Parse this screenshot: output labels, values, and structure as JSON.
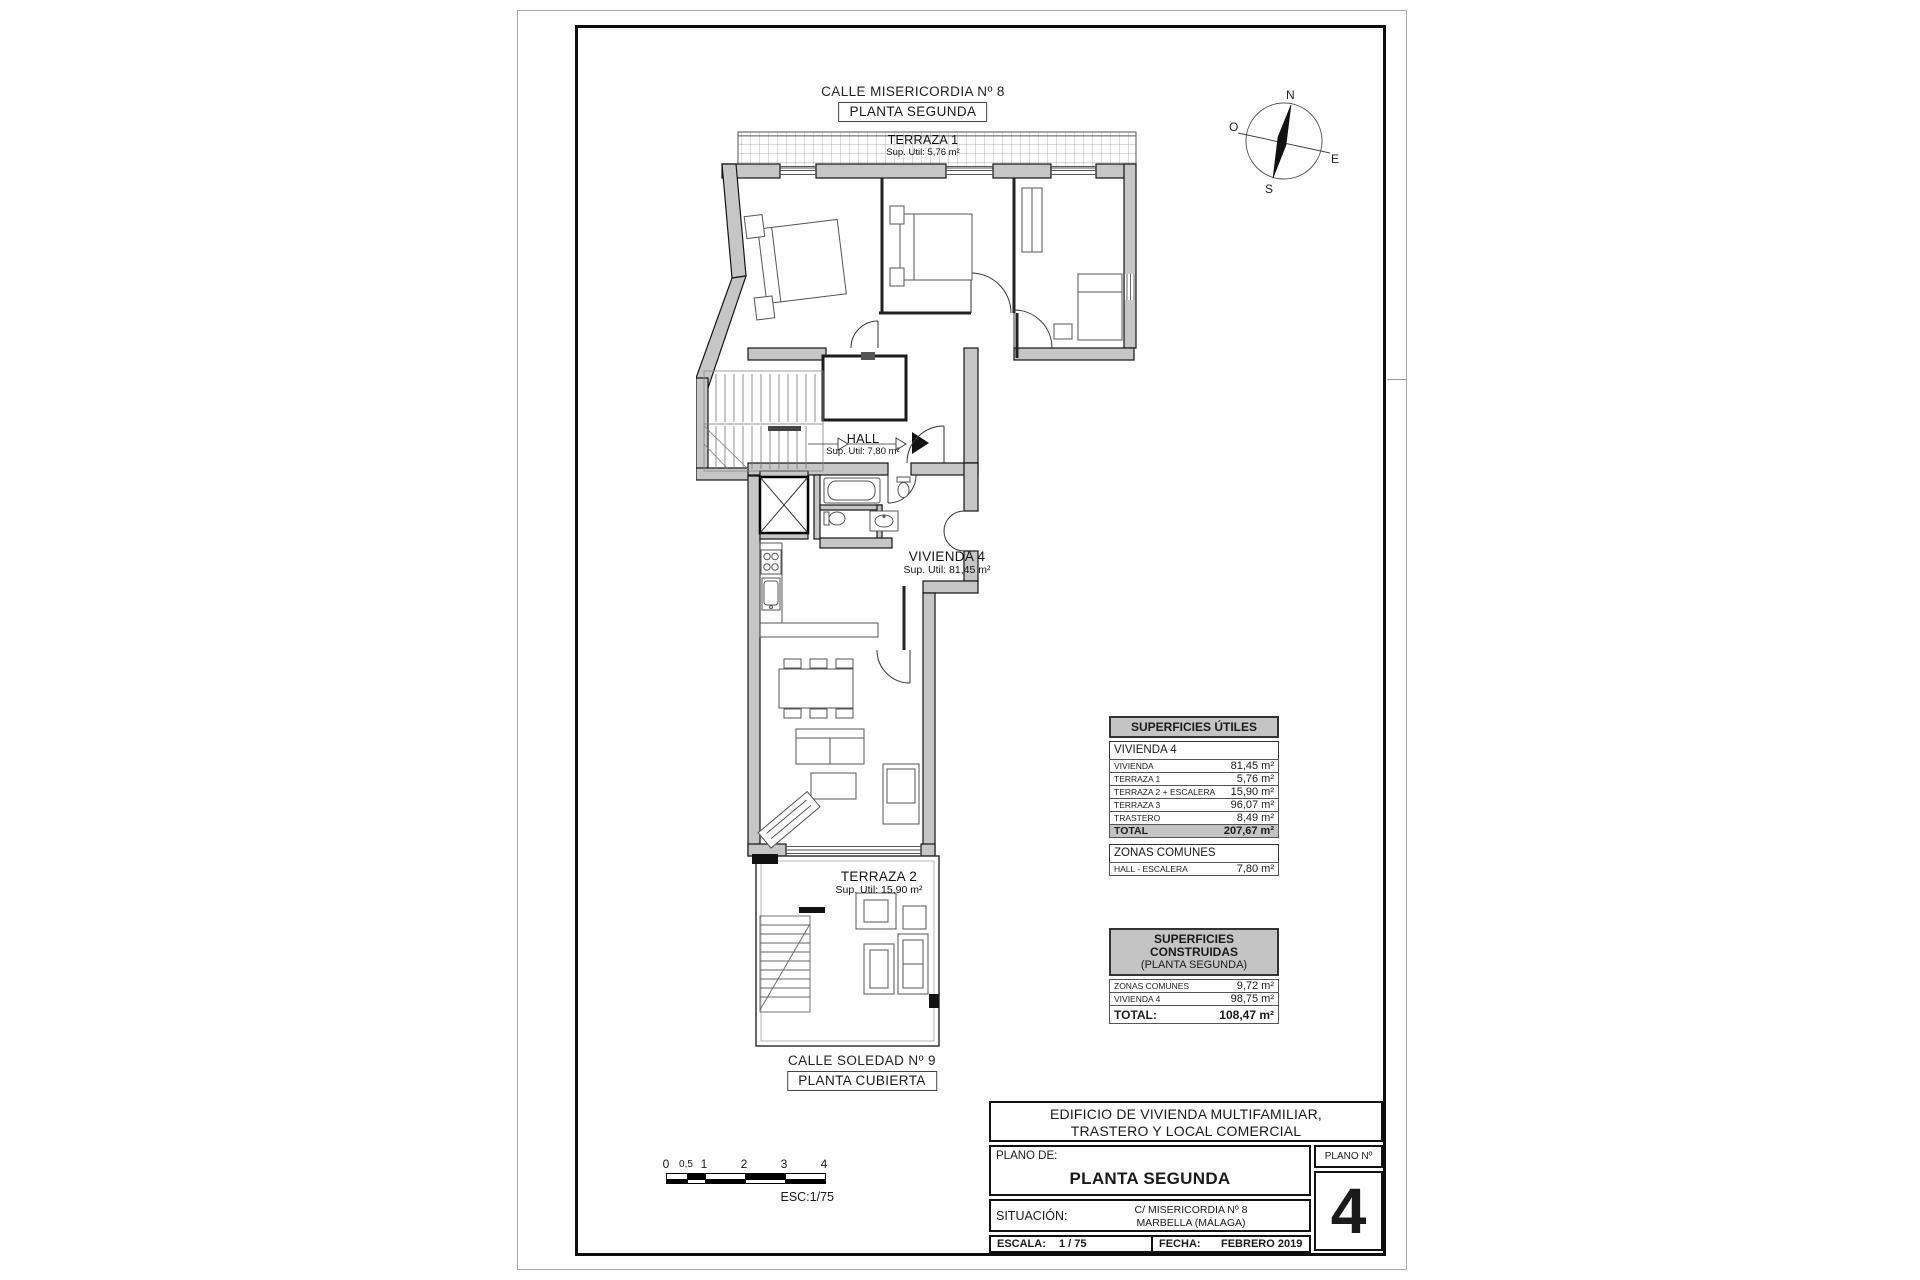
{
  "header": {
    "street": "CALLE MISERICORDIA Nº 8",
    "floor": "PLANTA SEGUNDA"
  },
  "footer": {
    "street": "CALLE SOLEDAD Nº 9",
    "floor": "PLANTA CUBIERTA"
  },
  "compass": {
    "n": "N",
    "s": "S",
    "e": "E",
    "o": "O"
  },
  "rooms": {
    "terraza1": {
      "name": "TERRAZA 1",
      "area": "Sup. Util: 5,76 m²"
    },
    "hall": {
      "name": "HALL",
      "area": "Sup. Util: 7,80 m²"
    },
    "vivienda": {
      "name": "VIVIENDA 4",
      "area": "Sup. Util: 81,45 m²"
    },
    "terraza2": {
      "name": "TERRAZA 2",
      "area": "Sup. Util: 15,90 m²"
    }
  },
  "utiles": {
    "title": "SUPERFICIES ÚTILES",
    "group": "VIVIENDA 4",
    "rows": [
      {
        "label": "VIVIENDA",
        "value": "81,45 m²"
      },
      {
        "label": "TERRAZA 1",
        "value": "5,76 m²"
      },
      {
        "label": "TERRAZA 2 + ESCALERA",
        "value": "15,90 m²"
      },
      {
        "label": "TERRAZA 3",
        "value": "96,07 m²"
      },
      {
        "label": "TRASTERO",
        "value": "8,49 m²"
      }
    ],
    "total": {
      "label": "TOTAL",
      "value": "207,67 m²"
    },
    "zonas_title": "ZONAS COMUNES",
    "zonas_row": {
      "label": "HALL - ESCALERA",
      "value": "7,80 m²"
    }
  },
  "construidas": {
    "title": "SUPERFICIES CONSTRUIDAS",
    "subtitle": "(PLANTA SEGUNDA)",
    "rows": [
      {
        "label": "ZONAS COMUNES",
        "value": "9,72 m²"
      },
      {
        "label": "VIVIENDA 4",
        "value": "98,75 m²"
      }
    ],
    "total": {
      "label": "TOTAL:",
      "value": "108,47 m²"
    }
  },
  "scalebar": {
    "ticks": [
      "0",
      "0,5",
      "1",
      "2",
      "3",
      "4"
    ],
    "esc": "ESC:1/75"
  },
  "titleblock": {
    "project_line1": "EDIFICIO DE VIVIENDA MULTIFAMILIAR,",
    "project_line2": "TRASTERO Y LOCAL COMERCIAL",
    "plano_de": "PLANO DE:",
    "plano_name": "PLANTA SEGUNDA",
    "plano_no_label": "PLANO Nº",
    "plano_no": "4",
    "situacion_label": "SITUACIÓN:",
    "situacion_line1": "C/ MISERICORDIA Nº 8",
    "situacion_line2": "MARBELLA (MÁLAGA)",
    "escala_label": "ESCALA:",
    "escala_value": "1 / 75",
    "fecha_label": "FECHA:",
    "fecha_value": "FEBRERO 2019"
  },
  "colors": {
    "wall": "#c6c6c6",
    "table_header": "#c4c4c4",
    "line": "#1a1a1a"
  }
}
